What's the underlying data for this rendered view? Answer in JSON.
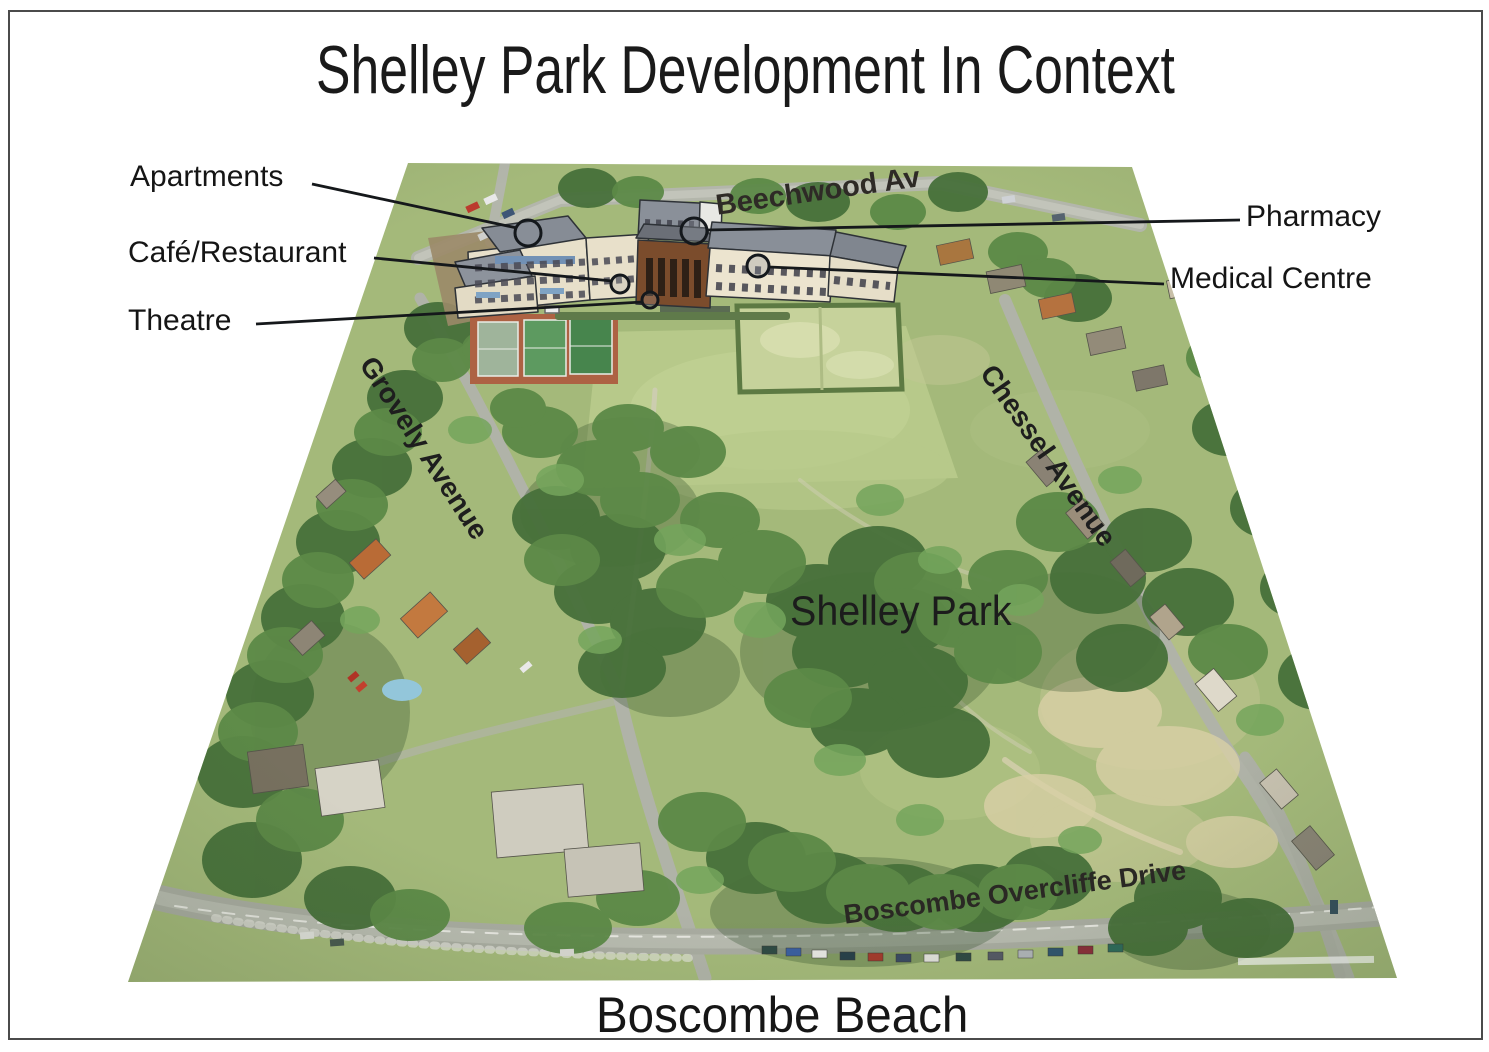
{
  "title": "Shelley Park Development In Context",
  "park_label": "Shelley Park",
  "beach_label": "Boscombe Beach",
  "callouts": {
    "apartments": "Apartments",
    "cafe_restaurant": "Café/Restaurant",
    "theatre": "Theatre",
    "pharmacy": "Pharmacy",
    "medical_centre": "Medical Centre"
  },
  "streets": {
    "beechwood": "Beechwood Av",
    "grovely": "Grovely Avenue",
    "chessel": "Chessel Avenue",
    "overcliffe": "Boscombe Overcliffe Drive"
  },
  "colors": {
    "callout_line": "#15181b",
    "page_border": "#4b4b4b",
    "park_green": "#a4b97a",
    "road_gray": "#b3b6ab",
    "tennis_court_clay": "#ad6243",
    "bowling_green": "#c6d29b"
  }
}
